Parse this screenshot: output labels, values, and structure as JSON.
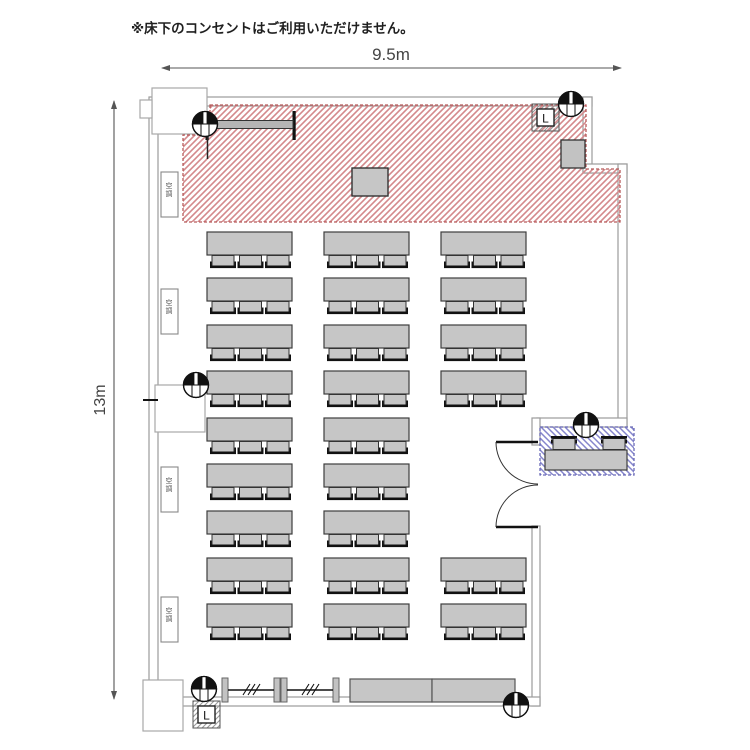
{
  "note": "※床下のコンセントはご利用いただけません。",
  "dimensions": {
    "width": "9.5m",
    "height": "13m"
  },
  "labels": {
    "ac": "空調",
    "panel": "L"
  },
  "colors": {
    "stage_hatch": "#d4898c",
    "stage_border": "#b65a5a",
    "reception_hatch": "#8585cc",
    "reception_border": "#6a6ab8",
    "furniture_fill": "#c6c6c6",
    "furniture_stroke": "#3d3d3d",
    "wall": "#9b9b9b"
  },
  "seating": {
    "table_width": 85,
    "table_height": 23,
    "chairs_per_table": 3,
    "row_y": [
      232,
      278,
      325,
      371,
      418,
      464,
      511,
      558,
      604
    ],
    "columns": [
      {
        "x": 207,
        "rows": [
          0,
          1,
          2,
          3,
          4,
          5,
          6,
          7,
          8
        ]
      },
      {
        "x": 324,
        "rows": [
          0,
          1,
          2,
          3,
          4,
          5,
          6,
          7,
          8
        ]
      },
      {
        "x": 441,
        "rows": [
          0,
          1,
          2,
          3,
          7,
          8
        ]
      }
    ],
    "table_count": 24,
    "seat_count": 72
  },
  "reception": {
    "table": {
      "x": 545,
      "y": 450,
      "width": 82,
      "height": 20
    },
    "chair_count": 2,
    "chair_x": [
      551,
      601
    ],
    "chair_y": 436
  }
}
